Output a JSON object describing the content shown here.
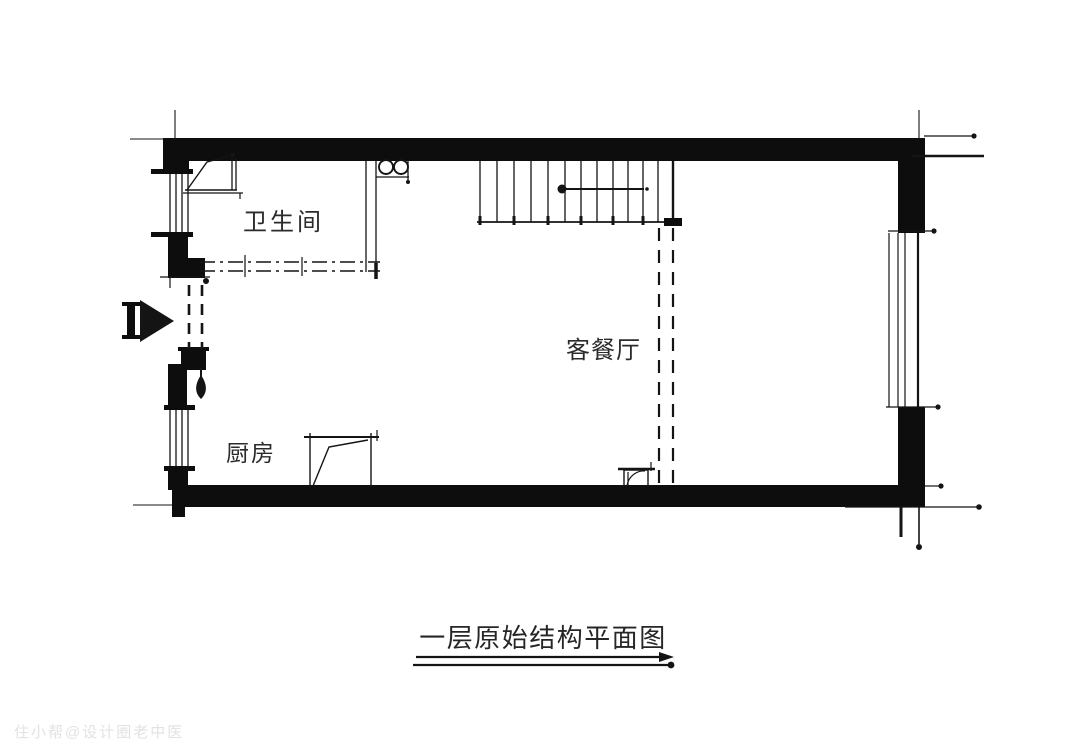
{
  "title": "一层原始结构平面图",
  "rooms": {
    "bathroom": "卫生间",
    "living_dining": "客餐厅",
    "kitchen": "厨房"
  },
  "watermark": "住小帮@设计圈老中医",
  "colors": {
    "line": "#141414",
    "wall": "#0d0d0d",
    "text": "#2b2b2b",
    "watermark": "#e2e2e2",
    "background": "#ffffff"
  }
}
